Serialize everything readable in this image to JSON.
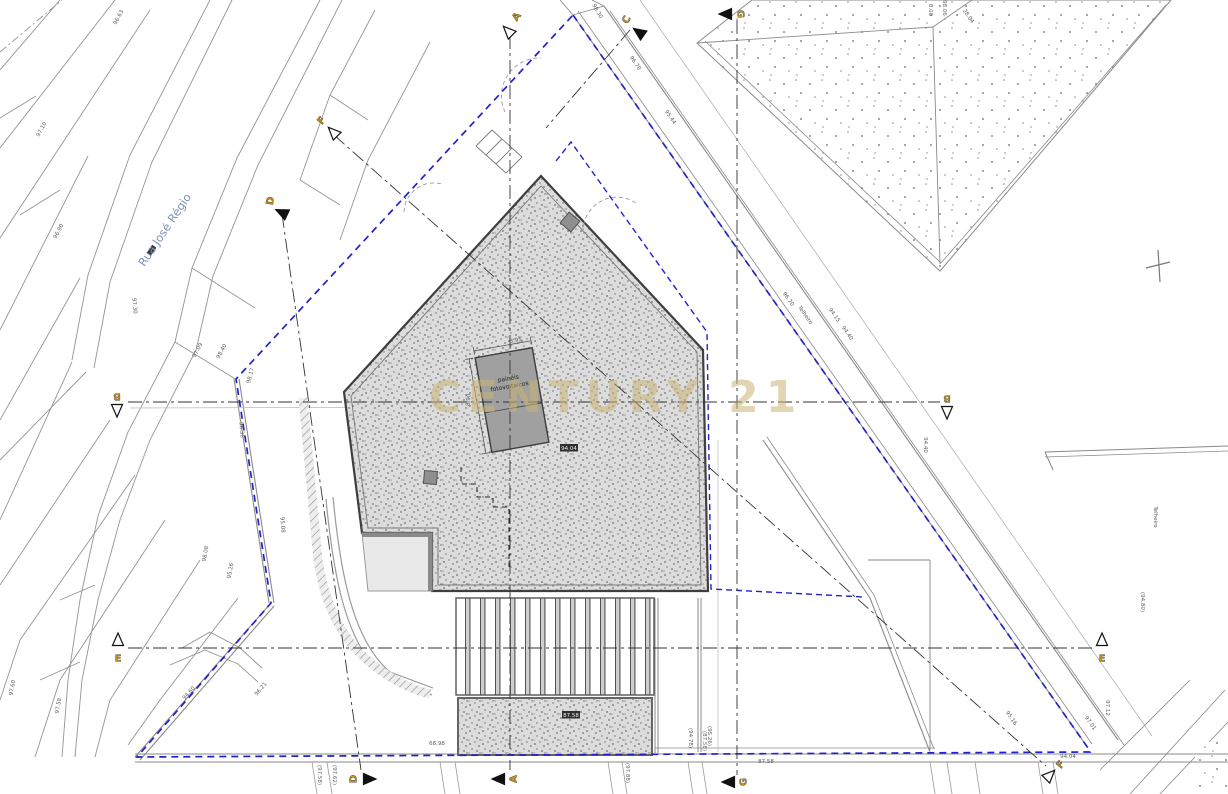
{
  "drawing": {
    "type": "architectural site plan / roof plan",
    "watermark": {
      "text": "CENTURY 21",
      "color": "rgba(201,178,118,0.55)"
    },
    "street": {
      "name": "Rua José Régio",
      "color": "#7d93b5"
    },
    "building": {
      "panels_label_line1": "painéis",
      "panels_label_line2": "fotovoltaicos",
      "panel_dim_top": "3.95",
      "panel_dim_side": "8.90",
      "level_box_main": "94.04",
      "level_box_patio": "87.58"
    },
    "colors": {
      "boundary_blue": "#2222cc",
      "marker_letter": "#c8931d",
      "wall_dark": "#3f3f3f",
      "parcel_gray": "#949494",
      "stipple_bg": "#dcdcdc"
    }
  },
  "section_markers": [
    {
      "letter": "A",
      "x": 517,
      "y": 17,
      "rot": -55,
      "ax": 509,
      "ay": 32,
      "angle": 225,
      "filled": false
    },
    {
      "letter": "C",
      "x": 627,
      "y": 20,
      "rot": -65,
      "ax": 640,
      "ay": 33,
      "angle": 215,
      "filled": true
    },
    {
      "letter": "G",
      "x": 740,
      "y": 14,
      "rot": 90,
      "ax": 727,
      "ay": 14,
      "angle": 180,
      "filled": true
    },
    {
      "letter": "F",
      "x": 322,
      "y": 121,
      "rot": -50,
      "ax": 334,
      "ay": 133,
      "angle": 225,
      "filled": false
    },
    {
      "letter": "D",
      "x": 271,
      "y": 201,
      "rot": -80,
      "ax": 283,
      "ay": 213,
      "angle": 205,
      "filled": true
    },
    {
      "letter": "B",
      "x": 117,
      "y": 396,
      "rot": 180,
      "ax": 117,
      "ay": 409,
      "angle": 90,
      "filled": false
    },
    {
      "letter": "B",
      "x": 947,
      "y": 398,
      "rot": 180,
      "ax": 947,
      "ay": 411,
      "angle": 90,
      "filled": false
    },
    {
      "letter": "E",
      "x": 118,
      "y": 659,
      "rot": 0,
      "ax": 118,
      "ay": 641,
      "angle": 270,
      "filled": false
    },
    {
      "letter": "E",
      "x": 1102,
      "y": 659,
      "rot": 0,
      "ax": 1102,
      "ay": 641,
      "angle": 270,
      "filled": false
    },
    {
      "letter": "D",
      "x": 354,
      "y": 779,
      "rot": -90,
      "ax": 368,
      "ay": 779,
      "angle": 0,
      "filled": true
    },
    {
      "letter": "A",
      "x": 514,
      "y": 779,
      "rot": -90,
      "ax": 500,
      "ay": 779,
      "angle": 180,
      "filled": true
    },
    {
      "letter": "G",
      "x": 744,
      "y": 782,
      "rot": -90,
      "ax": 730,
      "ay": 782,
      "angle": 180,
      "filled": true
    },
    {
      "letter": "F",
      "x": 1061,
      "y": 765,
      "rot": -50,
      "ax": 1049,
      "ay": 776,
      "angle": 315,
      "filled": false
    }
  ],
  "elevation_labels": [
    {
      "text": "97.09",
      "x": 199,
      "y": 351,
      "rot": -62
    },
    {
      "text": "98.40",
      "x": 223,
      "y": 352,
      "rot": -62
    },
    {
      "text": "98.17",
      "x": 252,
      "y": 376,
      "rot": -75
    },
    {
      "text": "96.36",
      "x": 240,
      "y": 430,
      "rot": 85
    },
    {
      "text": "95.08",
      "x": 281,
      "y": 525,
      "rot": 85
    },
    {
      "text": "98.08",
      "x": 207,
      "y": 554,
      "rot": -80
    },
    {
      "text": "95.26",
      "x": 232,
      "y": 571,
      "rot": -80
    },
    {
      "text": "96.21",
      "x": 262,
      "y": 690,
      "rot": -50
    },
    {
      "text": "97.30",
      "x": 133,
      "y": 306,
      "rot": 85
    },
    {
      "text": "96.90",
      "x": 60,
      "y": 232,
      "rot": -62
    },
    {
      "text": "97.10",
      "x": 43,
      "y": 130,
      "rot": -62
    },
    {
      "text": "96.63",
      "x": 120,
      "y": 18,
      "rot": -62
    },
    {
      "text": "98.30",
      "x": 596,
      "y": 12,
      "rot": 60
    },
    {
      "text": "96.70",
      "x": 634,
      "y": 64,
      "rot": 55
    },
    {
      "text": "95.44",
      "x": 669,
      "y": 118,
      "rot": 55
    },
    {
      "text": "94.15",
      "x": 833,
      "y": 316,
      "rot": 55
    },
    {
      "text": "94.40",
      "x": 846,
      "y": 334,
      "rot": 55
    },
    {
      "text": "94.40",
      "x": 924,
      "y": 445,
      "rot": 90
    },
    {
      "text": "8.00",
      "x": 929,
      "y": 10,
      "rot": 90
    },
    {
      "text": "28.04",
      "x": 967,
      "y": 17,
      "rot": 55
    },
    {
      "text": "98.06",
      "x": 943,
      "y": 8,
      "rot": 90
    },
    {
      "text": "96.70",
      "x": 787,
      "y": 300,
      "rot": 55
    },
    {
      "text": "Telheiro",
      "x": 804,
      "y": 316,
      "rot": 55
    },
    {
      "text": "94.60",
      "x": 190,
      "y": 694,
      "rot": -48
    },
    {
      "text": "97.58",
      "x": 60,
      "y": 706,
      "rot": -80
    },
    {
      "text": "97.60",
      "x": 14,
      "y": 688,
      "rot": -80
    },
    {
      "text": "(97.58)",
      "x": 318,
      "y": 775,
      "rot": 90
    },
    {
      "text": "(97.62)",
      "x": 333,
      "y": 775,
      "rot": 90
    },
    {
      "text": "68.98",
      "x": 437,
      "y": 745,
      "rot": 0
    },
    {
      "text": "(97.88)",
      "x": 626,
      "y": 773,
      "rot": 90
    },
    {
      "text": "(87.58)",
      "x": 703,
      "y": 741,
      "rot": 90
    },
    {
      "text": "87.58",
      "x": 766,
      "y": 763,
      "rot": 0
    },
    {
      "text": "(94.78)",
      "x": 689,
      "y": 738,
      "rot": 90
    },
    {
      "text": "(95.26)",
      "x": 708,
      "y": 736,
      "rot": 90
    },
    {
      "text": "95.16",
      "x": 1010,
      "y": 719,
      "rot": 55
    },
    {
      "text": "97.01",
      "x": 1089,
      "y": 724,
      "rot": 55
    },
    {
      "text": "97.12",
      "x": 1106,
      "y": 708,
      "rot": 90
    },
    {
      "text": "94.04",
      "x": 1068,
      "y": 758,
      "rot": 0
    },
    {
      "text": "Telheiro",
      "x": 1154,
      "y": 517,
      "rot": 90
    },
    {
      "text": "(94.80)",
      "x": 1141,
      "y": 602,
      "rot": 90
    },
    {
      "text": "3.95",
      "x": 516,
      "y": 342,
      "rot": -10
    },
    {
      "text": "8.90",
      "x": 470,
      "y": 400,
      "rot": -85
    }
  ]
}
